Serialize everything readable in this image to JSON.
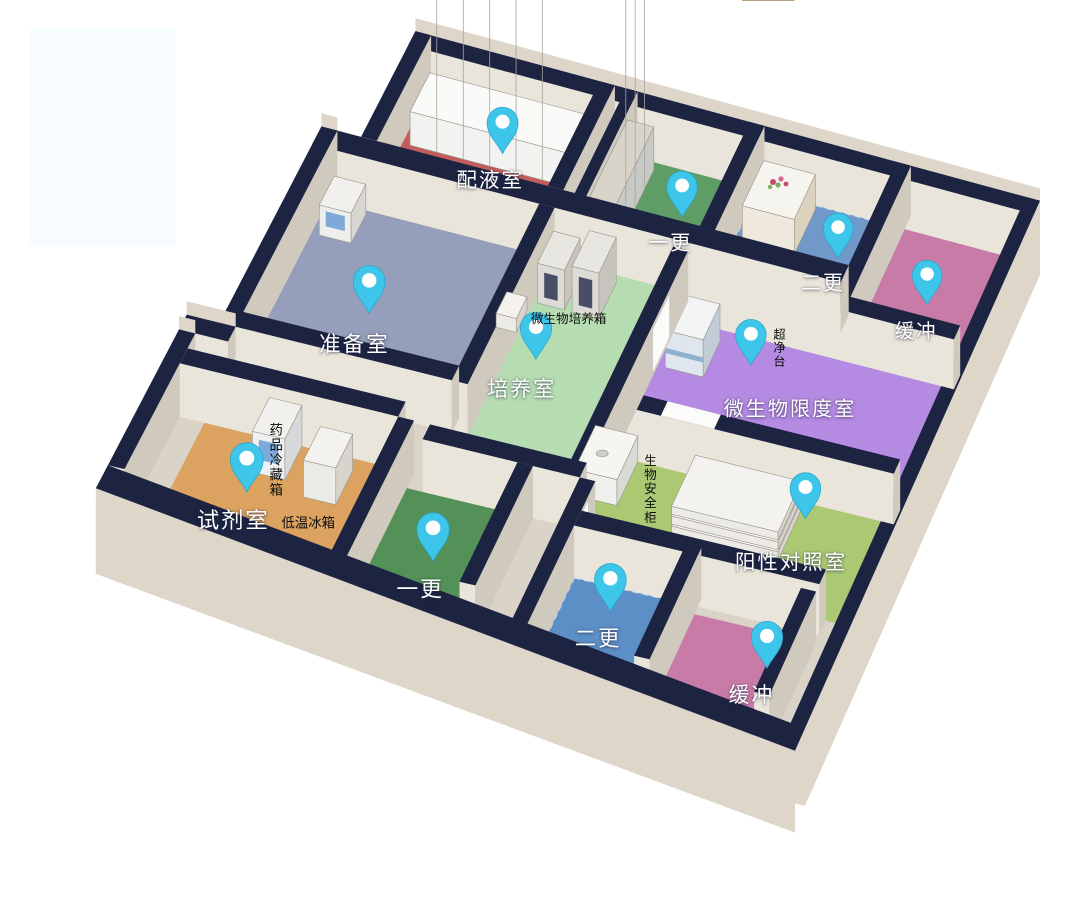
{
  "scene": {
    "width": 1068,
    "height": 918,
    "background": "#ffffff",
    "watermark": {
      "x": 30,
      "y": 28,
      "w": 145,
      "h": 218,
      "color": "#f7fcfe"
    }
  },
  "projection": {
    "plan_w": 100,
    "plan_h": 74,
    "wall_height": 52,
    "anchors": [
      {
        "plan": [
          0,
          0
        ],
        "screen": [
          290,
          49
        ]
      },
      {
        "plan": [
          100,
          0
        ],
        "screen": [
          1040,
          250
        ]
      },
      {
        "plan": [
          100,
          74
        ],
        "screen": [
          805,
          780
        ]
      },
      {
        "plan": [
          0,
          74
        ],
        "screen": [
          0,
          599
        ]
      }
    ]
  },
  "palette": {
    "navy": "#1d2442",
    "face_light": "#eae5da",
    "face_dark": "#d0c9bd",
    "outer_face": "#ddd6c9",
    "base_floor": "#d9d3c8",
    "box_top": "#f4f2ee",
    "box_front": "#eceae5",
    "box_side": "#d8d4cd",
    "box_edge": "#9a968c",
    "pin": "#3ec6ea",
    "pin_rim": "#29a7cd",
    "door_white": "#fbfbfa"
  },
  "base_floor_poly": [
    [
      16,
      0
    ],
    [
      100,
      0
    ],
    [
      100,
      74
    ],
    [
      7,
      62
    ],
    [
      7,
      44
    ],
    [
      11,
      44
    ],
    [
      11,
      15
    ],
    [
      16,
      15
    ]
  ],
  "rooms": [
    {
      "id": "peiyeshi",
      "label": "配液室",
      "color": "#c25d5c",
      "rect": [
        18,
        2,
        40,
        15
      ],
      "pin": [
        30,
        6
      ],
      "label_pos": [
        30,
        9.5
      ]
    },
    {
      "id": "zhunbeishi",
      "label": "准备室",
      "color": "#959ebb",
      "rect": [
        13,
        17.5,
        40,
        40
      ],
      "pin": [
        24,
        30
      ],
      "label_pos": [
        24,
        34
      ]
    },
    {
      "id": "yigeng-top",
      "label": "一更",
      "color": "#5f9d66",
      "rect": [
        45,
        2,
        60,
        16
      ],
      "pin": [
        54.5,
        8
      ],
      "label_pos": [
        54.5,
        11.5
      ]
    },
    {
      "id": "ergeng-top",
      "label": "二更",
      "color": "#7099c9",
      "rect": [
        62,
        2,
        80,
        17
      ],
      "pin": [
        75.5,
        8
      ],
      "label_pos": [
        75,
        11.5
      ],
      "dash": "#cfdcee"
    },
    {
      "id": "huanchong-top",
      "label": "缓冲",
      "color": "#c97ba7",
      "rect": [
        82,
        2,
        97,
        19
      ],
      "pin": [
        89,
        11
      ],
      "label_pos": [
        89,
        14.5
      ]
    },
    {
      "id": "weishengwu-xiandu",
      "label": "微生物限度室",
      "color": "#b58ae3",
      "rect": [
        60,
        21,
        97,
        38
      ],
      "pin": [
        71,
        24.5
      ],
      "label_pos": [
        78,
        28.5
      ]
    },
    {
      "id": "peiyangshi",
      "label": "培养室",
      "color": "#b6dcb1",
      "rect": [
        42,
        17.5,
        58,
        48
      ],
      "pin": [
        45.5,
        30.5
      ],
      "label_pos": [
        45.5,
        34.5
      ]
    },
    {
      "id": "shijishi",
      "label": "试剂室",
      "color": "#dba260",
      "rect": [
        12,
        48,
        36,
        62
      ],
      "pin": [
        20.5,
        55
      ],
      "label_pos": [
        20.5,
        58.5
      ]
    },
    {
      "id": "yigeng-bottom",
      "label": "一更",
      "color": "#539158",
      "rect": [
        38,
        50,
        52,
        66
      ],
      "pin": [
        45,
        58
      ],
      "label_pos": [
        45,
        61.5
      ]
    },
    {
      "id": "ergeng-bottom",
      "label": "二更",
      "color": "#5c8fc6",
      "rect": [
        62,
        56,
        76,
        70
      ],
      "pin": [
        68,
        59
      ],
      "label_pos": [
        68,
        62.5
      ],
      "dash": "#c5d5ea"
    },
    {
      "id": "yangxing-duizhao",
      "label": "阳性对照室",
      "color": "#abc873",
      "rect": [
        60,
        40,
        97,
        54
      ],
      "pin": [
        86,
        42
      ],
      "label_pos": [
        86.5,
        47.5
      ]
    },
    {
      "id": "huanchong-bottom",
      "label": "缓冲",
      "color": "#c97ba7",
      "rect": [
        78,
        57,
        92,
        70
      ],
      "pin": [
        89.5,
        61.5
      ],
      "label_pos": [
        89,
        65
      ]
    }
  ],
  "structure": [
    {
      "t": "wall",
      "name": "north-outer-wall",
      "r": [
        16,
        0,
        100,
        2
      ],
      "back": true
    },
    {
      "t": "wall",
      "name": "northwest-outer-wall",
      "r": [
        16,
        0,
        18,
        15
      ],
      "back": true
    },
    {
      "t": "box",
      "name": "cabinet-row",
      "r": [
        19,
        2.5,
        39.5,
        8
      ],
      "h": 34,
      "kind": "cabinets"
    },
    {
      "t": "wall",
      "name": "peiye-east-wall",
      "r": [
        40,
        0,
        42,
        15
      ]
    },
    {
      "t": "wall",
      "name": "corridor-west-wall",
      "r": [
        43.5,
        0,
        45,
        16
      ]
    },
    {
      "t": "box",
      "name": "locker-row",
      "r": [
        45,
        3,
        48.5,
        14
      ],
      "h": 44,
      "kind": "lockers"
    },
    {
      "t": "wall",
      "name": "yigeng-ergeng-top-wall",
      "r": [
        60,
        0,
        62,
        17
      ]
    },
    {
      "t": "box",
      "name": "slat-shelf",
      "r": [
        63,
        2.5,
        70,
        9
      ],
      "h": 36,
      "kind": "slats"
    },
    {
      "t": "wall",
      "name": "ergeng-huanchong-top-wall",
      "r": [
        80,
        0,
        82,
        19
      ]
    },
    {
      "t": "wall",
      "name": "east-outer-wall",
      "r": [
        98,
        0,
        100,
        74
      ],
      "outer": true
    },
    {
      "t": "wall",
      "name": "limit-room-north-wall",
      "r": [
        60,
        19,
        97,
        21
      ]
    },
    {
      "t": "wall",
      "name": "central-horizontal-wall",
      "r": [
        11,
        15,
        80,
        17.5
      ]
    },
    {
      "t": "wall",
      "name": "zhunbei-west-outer-wall",
      "r": [
        11,
        15,
        13,
        42
      ],
      "back": true
    },
    {
      "t": "box",
      "name": "zhunbei-cabinet",
      "r": [
        14,
        18,
        18,
        22
      ],
      "h": 30,
      "kind": "bluedoor"
    },
    {
      "t": "wall",
      "name": "zhunbei-east-wall",
      "r": [
        40,
        17.5,
        42,
        42
      ]
    },
    {
      "t": "box",
      "name": "incubator-1",
      "r": [
        42.5,
        19,
        46,
        23.5
      ],
      "h": 40,
      "kind": "panel"
    },
    {
      "t": "box",
      "name": "incubator-2",
      "r": [
        47,
        18.5,
        50.5,
        23.5
      ],
      "h": 46,
      "kind": "panel"
    },
    {
      "t": "box",
      "name": "clean-bench",
      "r": [
        61,
        22.5,
        66,
        27.5
      ],
      "h": 38,
      "kind": "bench"
    },
    {
      "t": "box",
      "name": "wall-mounted-unit",
      "r": [
        40.6,
        28,
        43.2,
        31
      ],
      "h": 14,
      "z": 26,
      "kind": "plain"
    },
    {
      "t": "wall",
      "name": "limit-room-south-wall",
      "r": [
        60,
        38,
        97,
        40
      ],
      "doorTop": [
        66,
        73
      ]
    },
    {
      "t": "wall",
      "name": "peiyang-east-wall",
      "r": [
        58,
        18.5,
        60,
        50
      ],
      "doorFace": [
        24,
        29
      ]
    },
    {
      "t": "box",
      "name": "biosafety-cabinet",
      "r": [
        57.5,
        40,
        63,
        46
      ],
      "h": 26,
      "kind": "sink"
    },
    {
      "t": "box",
      "name": "shelf-slab-1",
      "r": [
        71,
        41,
        85,
        48
      ],
      "h": 9,
      "kind": "plain"
    },
    {
      "t": "box",
      "name": "shelf-slab-2",
      "r": [
        71,
        41,
        85,
        48
      ],
      "h": 8,
      "z": 11,
      "kind": "plain"
    },
    {
      "t": "box",
      "name": "shelf-slab-3",
      "r": [
        71,
        41,
        85,
        48
      ],
      "h": 8,
      "z": 21,
      "kind": "plain"
    },
    {
      "t": "wall",
      "name": "zhunbei-south-wall",
      "r": [
        11,
        40,
        40,
        42
      ]
    },
    {
      "t": "wall",
      "name": "annex-step-wall",
      "r": [
        7,
        42,
        13,
        44
      ],
      "back": true
    },
    {
      "t": "wall",
      "name": "shiji-west-outer-wall",
      "r": [
        7,
        44,
        9,
        62
      ],
      "back": true
    },
    {
      "t": "wall",
      "name": "shiji-north-wall",
      "r": [
        9,
        46,
        36,
        48
      ]
    },
    {
      "t": "box",
      "name": "medicine-fridge",
      "r": [
        20,
        48,
        24,
        52.5
      ],
      "h": 40,
      "kind": "bluewin"
    },
    {
      "t": "box",
      "name": "low-temp-freezer",
      "r": [
        27,
        49.5,
        31,
        54
      ],
      "h": 36,
      "kind": "plain"
    },
    {
      "t": "wall",
      "name": "peiyang-south-wall",
      "r": [
        40,
        48,
        60,
        50
      ]
    },
    {
      "t": "wall",
      "name": "shiji-yigengb-wall",
      "r": [
        36,
        48,
        38,
        66
      ]
    },
    {
      "t": "wall",
      "name": "yigengb-east-wall",
      "r": [
        52,
        50,
        54,
        66
      ]
    },
    {
      "t": "wall",
      "name": "ergengb-west-wall",
      "r": [
        60,
        50,
        62,
        70
      ],
      "doorFace": [
        52,
        56
      ]
    },
    {
      "t": "wall",
      "name": "yangxing-south-wall",
      "r": [
        62,
        54,
        94,
        56
      ]
    },
    {
      "t": "wall",
      "name": "ergengb-huanchongb-wall",
      "r": [
        76,
        55,
        78,
        70
      ]
    },
    {
      "t": "wall",
      "name": "huanchongb-east-wall",
      "r": [
        92,
        57,
        94,
        71
      ]
    },
    {
      "t": "wallq",
      "name": "southwest-outer-wall",
      "q": [
        [
          7,
          62
        ],
        [
          100,
          74
        ],
        [
          100,
          77
        ],
        [
          7,
          65
        ]
      ],
      "outer": true
    }
  ],
  "equipment_labels": [
    {
      "text": "微生物培养箱",
      "plan": [
        47,
        24.5
      ],
      "vertical": false
    },
    {
      "text": "超净台",
      "plan": [
        73.5,
        21.5
      ],
      "vertical": true
    },
    {
      "text": "药品冷藏箱",
      "plan": [
        22,
        50.5
      ],
      "vertical": true
    },
    {
      "text": "低温冰箱",
      "plan": [
        29,
        57
      ],
      "vertical": false
    },
    {
      "text": "生物安全柜",
      "plan": [
        66,
        43
      ],
      "vertical": true
    }
  ]
}
